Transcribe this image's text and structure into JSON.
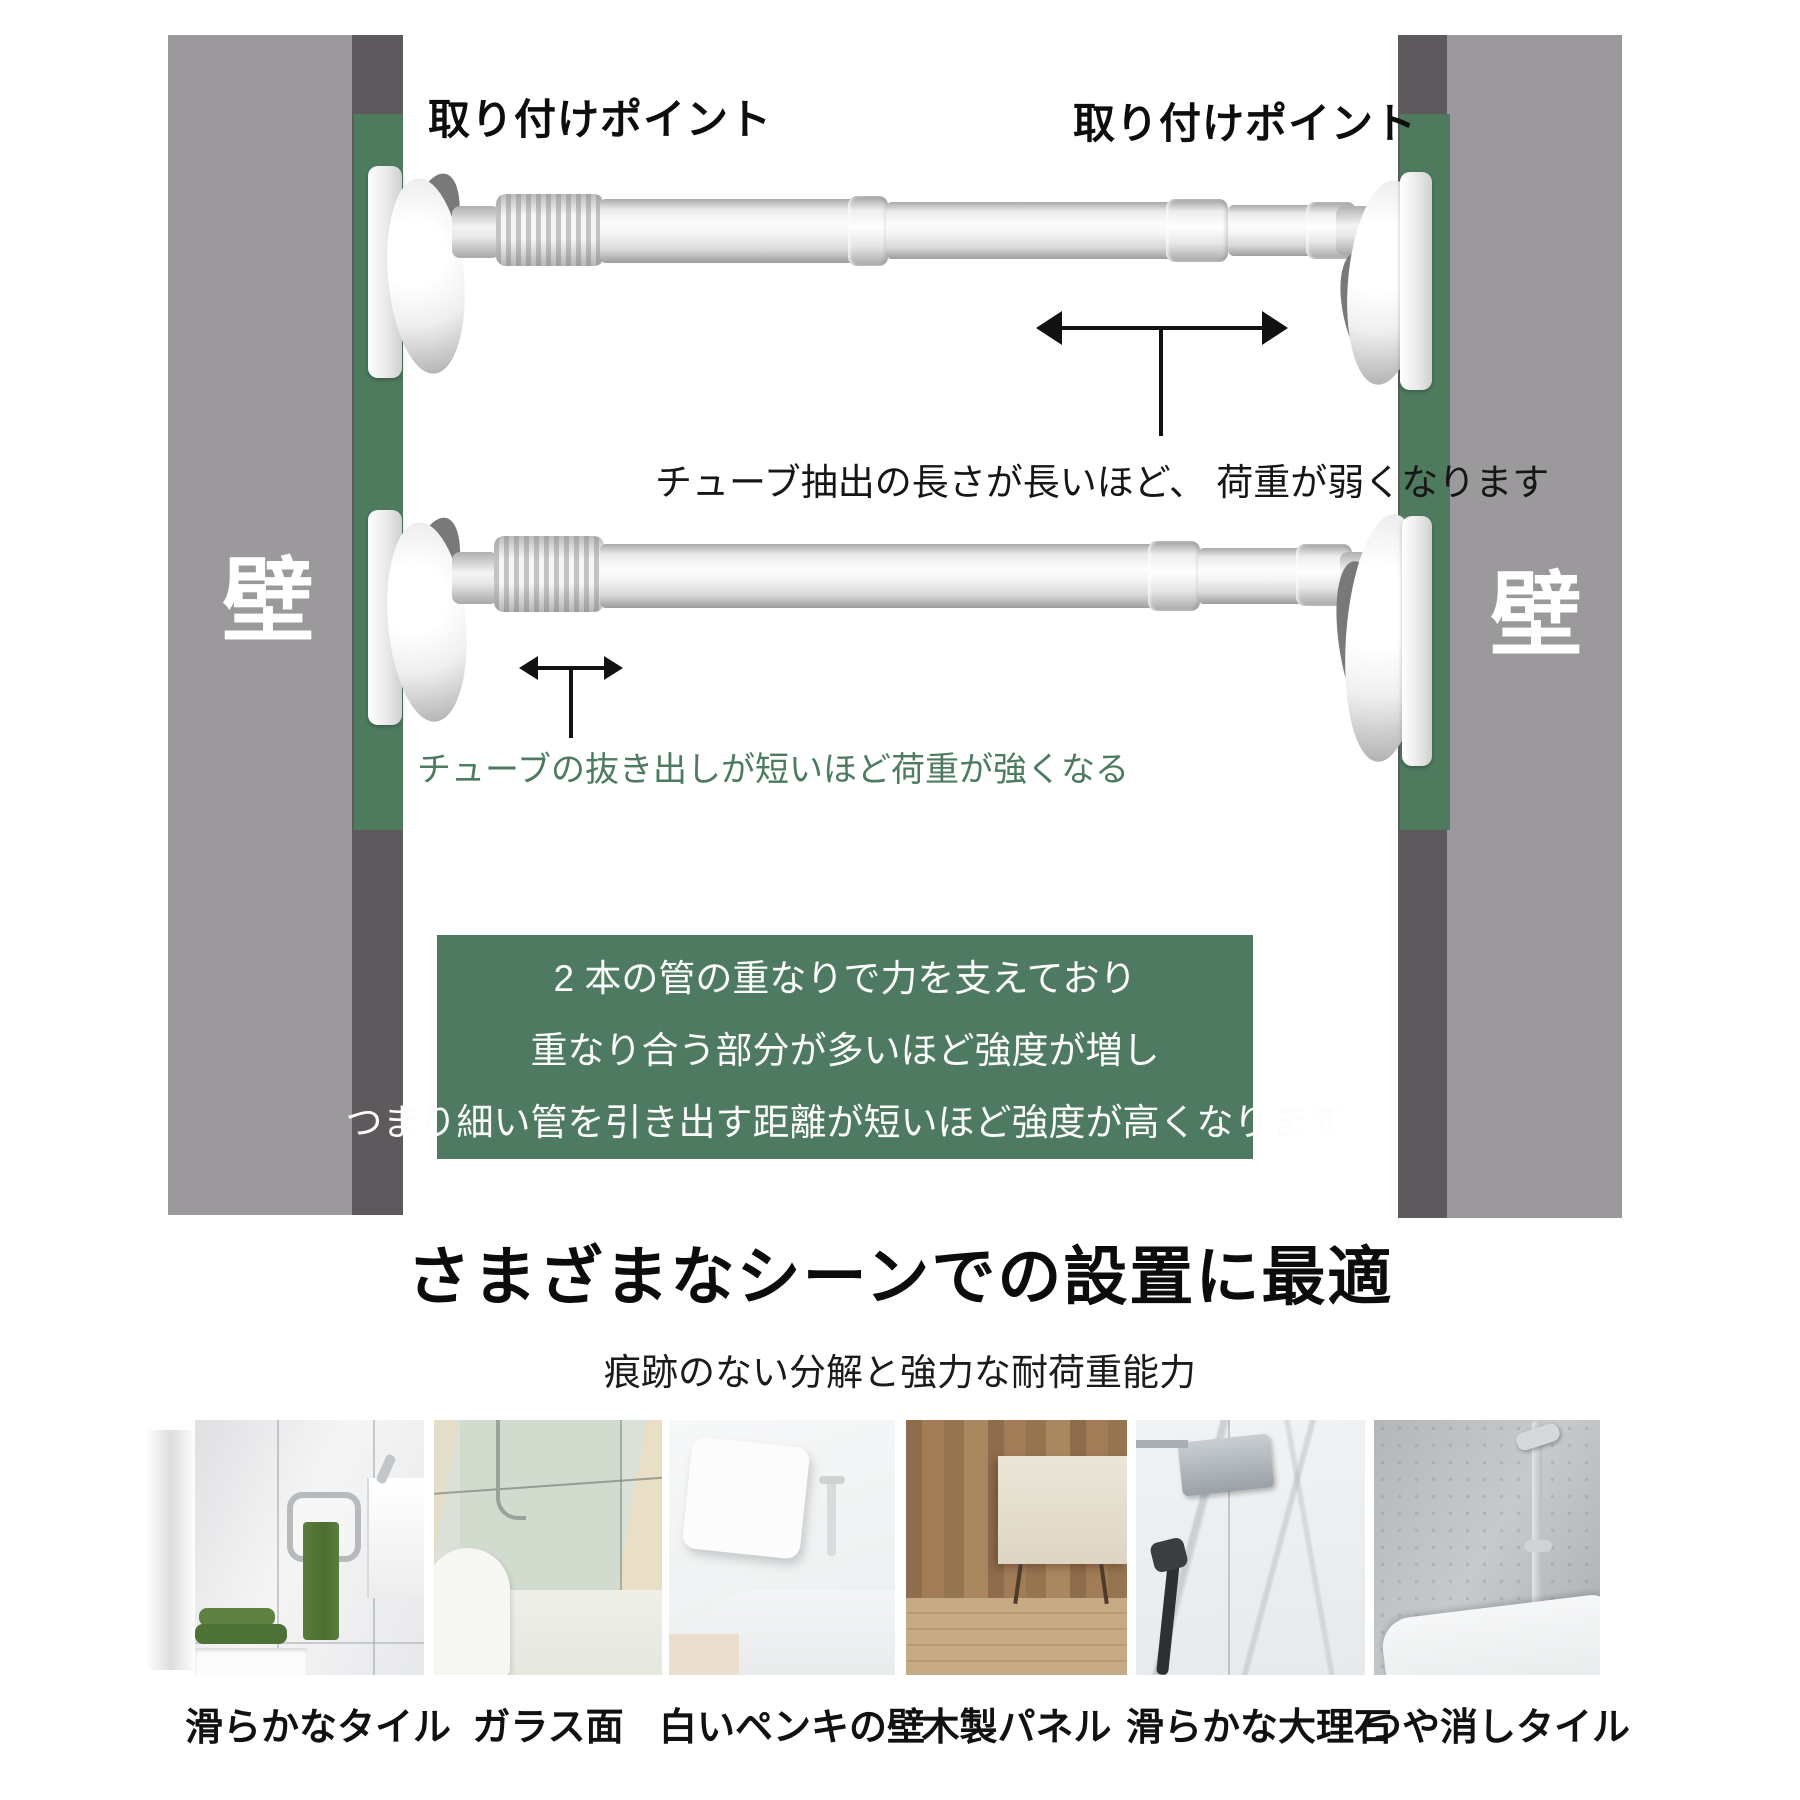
{
  "page": {
    "background": "#ffffff",
    "accent_green": "#4d7a60",
    "wall_gray": "#9b999c",
    "wall_edge_gray": "#5d595c",
    "green_strip": "#4e7b5e"
  },
  "walls": {
    "left_label": "壁",
    "right_label": "壁"
  },
  "labels": {
    "mount_point_left": "取り付けポイント",
    "mount_point_right": "取り付けポイント"
  },
  "notes": {
    "long_extension": "チューブ抽出の長さが長いほど、 荷重が弱くなります",
    "short_extension": "チューブの抜き出しが短いほど荷重が強くなる",
    "short_extension_color": "#4c7b5f"
  },
  "info_box": {
    "background": "#4d7a60",
    "text_color": "#fcfcfc",
    "lines": [
      "2 本の管の重なりで力を支えており",
      "重なり合う部分が多いほど強度が増し",
      "つまり細い管を引き出す距離が短いほど強度が高くなります"
    ]
  },
  "section": {
    "heading": "さまざまなシーンでの設置に最適",
    "subheading": "痕跡のない分解と強力な耐荷重能力"
  },
  "surfaces": [
    {
      "caption": "滑らかなタイル"
    },
    {
      "caption": "ガラス面"
    },
    {
      "caption": "白いペンキの壁"
    },
    {
      "caption": "木製パネル"
    },
    {
      "caption": "滑らかな大理石"
    },
    {
      "caption": "つや消しタイル"
    }
  ]
}
